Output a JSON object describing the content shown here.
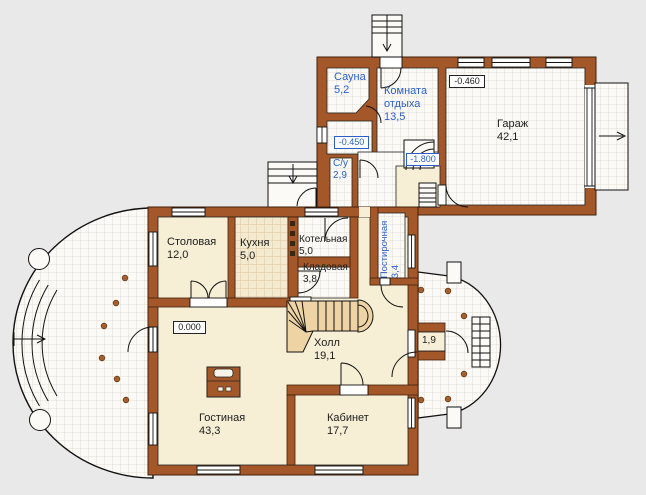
{
  "plan": {
    "colors": {
      "wall": "#a4582a",
      "cream_floor": "#f6efd6",
      "tile_floor": "#fbfaf6",
      "kitchen_tile": "#f3ead0",
      "stair_wood": "#eed4a5",
      "label_blue": "#2b5fc7",
      "label_black": "#1c1c1c",
      "background": "#e9e9e9"
    },
    "rooms": [
      {
        "name": "sauna",
        "label": "Сауна\n5,2"
      },
      {
        "name": "rest-room",
        "label": "Комната\nотдыха\n13,5"
      },
      {
        "name": "garage",
        "label": "Гараж\n42,1"
      },
      {
        "name": "wc",
        "label": "С/у\n2,9"
      },
      {
        "name": "laundry",
        "label": "Постирочная\n3,4"
      },
      {
        "name": "dining",
        "label": "Столовая\n12,0"
      },
      {
        "name": "kitchen",
        "label": "Кухня\n5,0"
      },
      {
        "name": "boiler",
        "label": "Котельная\n5,0"
      },
      {
        "name": "pantry",
        "label": "Кладовая\n3,8"
      },
      {
        "name": "hall",
        "label": "Холл\n19,1"
      },
      {
        "name": "living",
        "label": "Гостиная\n43,3"
      },
      {
        "name": "study",
        "label": "Кабинет\n17,7"
      },
      {
        "name": "vestibule",
        "label": "1,9"
      }
    ],
    "level_markers": {
      "ground": "0.000",
      "garage": "-0.460",
      "sauna_lobby": "-0.450",
      "basement_landing": "-1.800"
    }
  }
}
